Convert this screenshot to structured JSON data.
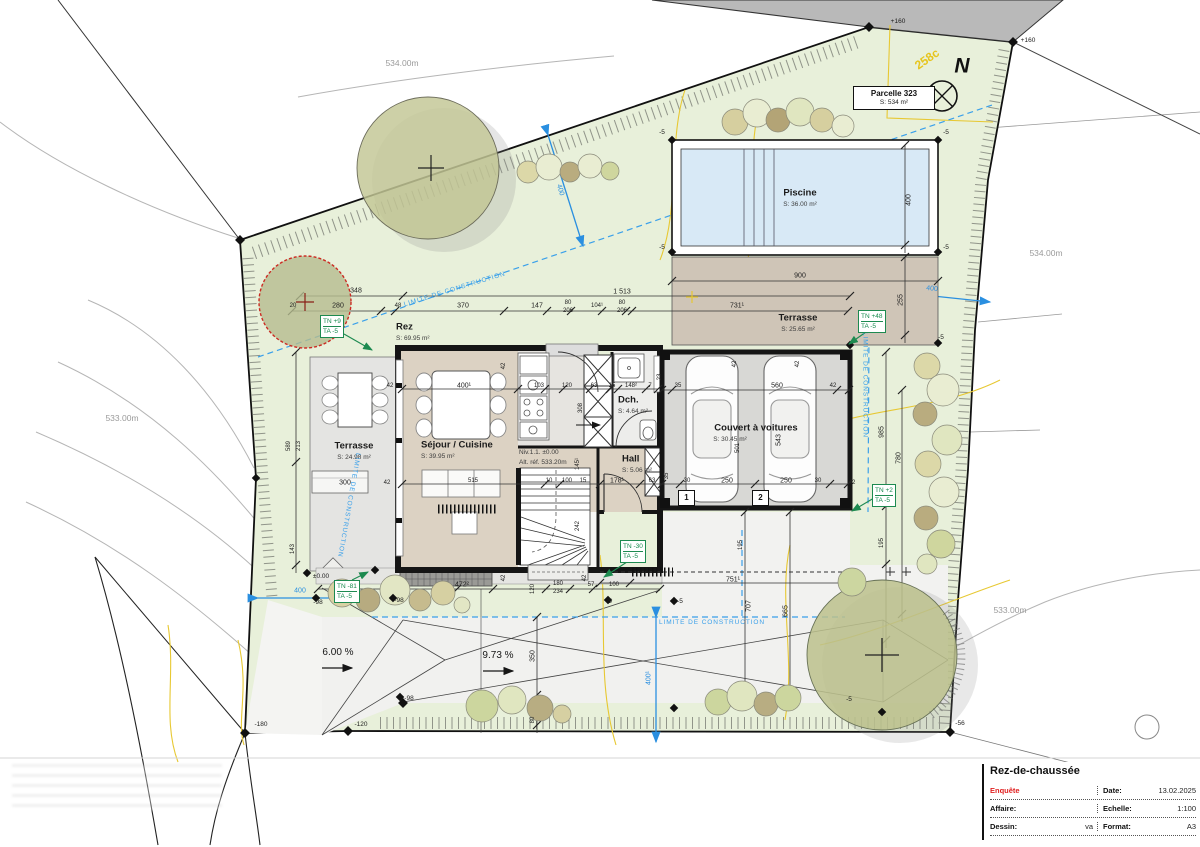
{
  "title_block": {
    "title": "Rez-de-chaussée",
    "rows": [
      {
        "l": "Enquête",
        "lv": "",
        "rl": "Date:",
        "rv": "13.02.2025"
      },
      {
        "l": "Affaire:",
        "lv": "",
        "rl": "Echelle:",
        "rv": "1:100"
      },
      {
        "l": "Dessin:",
        "lv": "va",
        "rl": "Format:",
        "rv": "A3"
      }
    ]
  },
  "parcel_box": {
    "name": "Parcelle 323",
    "area": "S: 534 m²"
  },
  "north": {
    "letter": "N",
    "zone_code": "258c"
  },
  "terrain_tags": [
    {
      "tn": "TN +9",
      "ta": "TA -5"
    },
    {
      "tn": "TN +48",
      "ta": "TA -5"
    },
    {
      "tn": "TN +2",
      "ta": "TA -5"
    },
    {
      "tn": "TN -30",
      "ta": "TA -5"
    },
    {
      "tn": "TN -81",
      "ta": "TA -5"
    }
  ],
  "parking_spots": [
    "1",
    "2"
  ],
  "plan": {
    "labels": [
      {
        "t": "534.00m",
        "x": 402,
        "y": 63,
        "c": "contour"
      },
      {
        "t": "534.00m",
        "x": 1046,
        "y": 253,
        "c": "contour"
      },
      {
        "t": "533.00m",
        "x": 122,
        "y": 418,
        "c": "contour"
      },
      {
        "t": "533.00m",
        "x": 1010,
        "y": 610,
        "c": "contour"
      },
      {
        "t": "+160",
        "x": 898,
        "y": 22,
        "c": "marker"
      },
      {
        "t": "+160",
        "x": 1028,
        "y": 41,
        "c": "marker"
      },
      {
        "t": "258c",
        "x": 927,
        "y": 59,
        "c": "yellow",
        "r": -35
      },
      {
        "t": "N",
        "x": 962,
        "y": 66,
        "c": "north"
      },
      {
        "t": "Piscine",
        "x": 800,
        "y": 193,
        "c": "room"
      },
      {
        "t": "S: 36.00 m²",
        "x": 800,
        "y": 205,
        "c": "area"
      },
      {
        "t": "Terrasse",
        "x": 798,
        "y": 318,
        "c": "room"
      },
      {
        "t": "S: 25.65 m²",
        "x": 798,
        "y": 330,
        "c": "area"
      },
      {
        "t": "Rez",
        "x": 396,
        "y": 327,
        "c": "room",
        "a": "l"
      },
      {
        "t": "S: 69.95 m²",
        "x": 396,
        "y": 339,
        "c": "area",
        "a": "l"
      },
      {
        "t": "Séjour / Cuisine",
        "x": 421,
        "y": 445,
        "c": "room",
        "a": "l"
      },
      {
        "t": "S: 39.95 m²",
        "x": 421,
        "y": 457,
        "c": "area",
        "a": "l"
      },
      {
        "t": "Dch.",
        "x": 618,
        "y": 400,
        "c": "room",
        "a": "l"
      },
      {
        "t": "S: 4.64 m²",
        "x": 618,
        "y": 412,
        "c": "area",
        "a": "l"
      },
      {
        "t": "Hall",
        "x": 622,
        "y": 459,
        "c": "room",
        "a": "l"
      },
      {
        "t": "S: 5.06 m²",
        "x": 622,
        "y": 471,
        "c": "area",
        "a": "l"
      },
      {
        "t": "Terrasse",
        "x": 354,
        "y": 446,
        "c": "room"
      },
      {
        "t": "S: 24.98 m²",
        "x": 354,
        "y": 458,
        "c": "area"
      },
      {
        "t": "Couvert à voitures",
        "x": 756,
        "y": 428,
        "c": "room"
      },
      {
        "t": "S: 30.45 m²",
        "x": 730,
        "y": 440,
        "c": "area"
      },
      {
        "t": "Niv.1.1. ±0.00",
        "x": 519,
        "y": 453,
        "c": "area",
        "a": "l"
      },
      {
        "t": "Alt. réf. 533.20m",
        "x": 519,
        "y": 463,
        "c": "area",
        "a": "l"
      },
      {
        "t": "348",
        "x": 356,
        "y": 291,
        "c": "dim"
      },
      {
        "t": "1 513",
        "x": 622,
        "y": 292,
        "c": "dim"
      },
      {
        "t": "900",
        "x": 800,
        "y": 276,
        "c": "dim"
      },
      {
        "t": "20",
        "x": 293,
        "y": 306,
        "c": "dimsm"
      },
      {
        "t": "280",
        "x": 338,
        "y": 306,
        "c": "dim"
      },
      {
        "t": "48",
        "x": 398,
        "y": 306,
        "c": "dimsm"
      },
      {
        "t": "370",
        "x": 463,
        "y": 306,
        "c": "dim"
      },
      {
        "t": "147",
        "x": 537,
        "y": 306,
        "c": "dim"
      },
      {
        "t": "80",
        "x": 568,
        "y": 303,
        "c": "dimsm"
      },
      {
        "t": "206",
        "x": 568,
        "y": 311,
        "c": "dimsm"
      },
      {
        "t": "104¹",
        "x": 597,
        "y": 306,
        "c": "dimsm"
      },
      {
        "t": "80",
        "x": 622,
        "y": 303,
        "c": "dimsm"
      },
      {
        "t": "206",
        "x": 622,
        "y": 311,
        "c": "dimsm"
      },
      {
        "t": "731¹",
        "x": 737,
        "y": 306,
        "c": "dim"
      },
      {
        "t": "400",
        "x": 909,
        "y": 200,
        "c": "dim",
        "r": -90
      },
      {
        "t": "255",
        "x": 901,
        "y": 300,
        "c": "dim",
        "r": -90
      },
      {
        "t": "589",
        "x": 289,
        "y": 446,
        "c": "dimsm",
        "r": -90
      },
      {
        "t": "213",
        "x": 299,
        "y": 446,
        "c": "dimsm",
        "r": -90
      },
      {
        "t": "143",
        "x": 293,
        "y": 549,
        "c": "dimsm",
        "r": -90
      },
      {
        "t": "42",
        "x": 390,
        "y": 386,
        "c": "dimsm"
      },
      {
        "t": "400¹",
        "x": 464,
        "y": 386,
        "c": "dim"
      },
      {
        "t": "103",
        "x": 539,
        "y": 386,
        "c": "dimsm"
      },
      {
        "t": "120",
        "x": 567,
        "y": 386,
        "c": "dimsm"
      },
      {
        "t": "63",
        "x": 594,
        "y": 386,
        "c": "dimsm"
      },
      {
        "t": "15",
        "x": 612,
        "y": 386,
        "c": "dimsm"
      },
      {
        "t": "148²",
        "x": 631,
        "y": 386,
        "c": "dimsm"
      },
      {
        "t": "7",
        "x": 650,
        "y": 386,
        "c": "dimsm"
      },
      {
        "t": "23",
        "x": 660,
        "y": 377,
        "c": "dimsm",
        "r": -90
      },
      {
        "t": "308",
        "x": 581,
        "y": 408,
        "c": "dimsm",
        "r": -90
      },
      {
        "t": "42",
        "x": 504,
        "y": 366,
        "c": "dimsm",
        "r": -90
      },
      {
        "t": "35",
        "x": 678,
        "y": 386,
        "c": "dimsm"
      },
      {
        "t": "560",
        "x": 777,
        "y": 386,
        "c": "dim"
      },
      {
        "t": "42",
        "x": 833,
        "y": 386,
        "c": "dimsm"
      },
      {
        "t": "42",
        "x": 735,
        "y": 364,
        "c": "dimsm",
        "r": -90
      },
      {
        "t": "42",
        "x": 798,
        "y": 364,
        "c": "dimsm",
        "r": -90
      },
      {
        "t": "543",
        "x": 779,
        "y": 440,
        "c": "dim",
        "r": -90
      },
      {
        "t": "501",
        "x": 738,
        "y": 448,
        "c": "dimsm",
        "r": -90
      },
      {
        "t": "515",
        "x": 473,
        "y": 481,
        "c": "dimsm"
      },
      {
        "t": "10",
        "x": 549,
        "y": 481,
        "c": "dimsm"
      },
      {
        "t": "100",
        "x": 567,
        "y": 481,
        "c": "dimsm"
      },
      {
        "t": "15",
        "x": 583,
        "y": 481,
        "c": "dimsm"
      },
      {
        "t": "178¹",
        "x": 617,
        "y": 481,
        "c": "dim"
      },
      {
        "t": "63",
        "x": 652,
        "y": 481,
        "c": "dimsm"
      },
      {
        "t": "30",
        "x": 687,
        "y": 481,
        "c": "dimsm"
      },
      {
        "t": "250",
        "x": 727,
        "y": 481,
        "c": "dim"
      },
      {
        "t": "250",
        "x": 786,
        "y": 481,
        "c": "dim"
      },
      {
        "t": "30",
        "x": 818,
        "y": 481,
        "c": "dimsm"
      },
      {
        "t": "35",
        "x": 667,
        "y": 476,
        "c": "dimsm",
        "r": -90
      },
      {
        "t": "145¹",
        "x": 578,
        "y": 464,
        "c": "dimsm",
        "r": -90
      },
      {
        "t": "242",
        "x": 578,
        "y": 526,
        "c": "dimsm",
        "r": -90
      },
      {
        "t": "300",
        "x": 345,
        "y": 483,
        "c": "dim"
      },
      {
        "t": "42",
        "x": 387,
        "y": 483,
        "c": "dimsm"
      },
      {
        "t": "42",
        "x": 852,
        "y": 483,
        "c": "dimsm"
      },
      {
        "t": "985",
        "x": 882,
        "y": 432,
        "c": "dim",
        "r": -90
      },
      {
        "t": "780",
        "x": 899,
        "y": 458,
        "c": "dim",
        "r": -90
      },
      {
        "t": "195",
        "x": 882,
        "y": 543,
        "c": "dimsm",
        "r": -90
      },
      {
        "t": "195",
        "x": 741,
        "y": 545,
        "c": "dimsm",
        "r": -90
      },
      {
        "t": "472²",
        "x": 462,
        "y": 585,
        "c": "dim"
      },
      {
        "t": "120",
        "x": 533,
        "y": 589,
        "c": "dimsm",
        "r": -90
      },
      {
        "t": "180",
        "x": 558,
        "y": 584,
        "c": "dimsm"
      },
      {
        "t": "234",
        "x": 558,
        "y": 592,
        "c": "dimsm"
      },
      {
        "t": "57",
        "x": 591,
        "y": 585,
        "c": "dimsm"
      },
      {
        "t": "100",
        "x": 614,
        "y": 585,
        "c": "dimsm"
      },
      {
        "t": "42",
        "x": 504,
        "y": 578,
        "c": "dimsm",
        "r": -90
      },
      {
        "t": "42",
        "x": 585,
        "y": 578,
        "c": "dimsm",
        "r": -90
      },
      {
        "t": "751¹",
        "x": 733,
        "y": 580,
        "c": "dim"
      },
      {
        "t": "707",
        "x": 749,
        "y": 606,
        "c": "dim",
        "r": -90
      },
      {
        "t": "665",
        "x": 786,
        "y": 611,
        "c": "dim",
        "r": -90
      },
      {
        "t": "350",
        "x": 533,
        "y": 656,
        "c": "dim",
        "r": -90
      },
      {
        "t": "80",
        "x": 533,
        "y": 720,
        "c": "dimsm",
        "r": -90
      },
      {
        "t": "-5",
        "x": 662,
        "y": 133,
        "c": "marker"
      },
      {
        "t": "-5",
        "x": 946,
        "y": 133,
        "c": "marker"
      },
      {
        "t": "-5",
        "x": 662,
        "y": 248,
        "c": "marker"
      },
      {
        "t": "-5",
        "x": 946,
        "y": 248,
        "c": "marker"
      },
      {
        "t": "-5",
        "x": 941,
        "y": 338,
        "c": "marker"
      },
      {
        "t": "-5",
        "x": 609,
        "y": 602,
        "c": "marker"
      },
      {
        "t": "-5",
        "x": 680,
        "y": 602,
        "c": "marker"
      },
      {
        "t": "-5",
        "x": 849,
        "y": 700,
        "c": "marker"
      },
      {
        "t": "-56",
        "x": 960,
        "y": 724,
        "c": "marker"
      },
      {
        "t": "-98",
        "x": 318,
        "y": 603,
        "c": "marker"
      },
      {
        "t": "-98",
        "x": 399,
        "y": 601,
        "c": "marker"
      },
      {
        "t": "-98",
        "x": 409,
        "y": 699,
        "c": "marker"
      },
      {
        "t": "-120",
        "x": 361,
        "y": 725,
        "c": "marker"
      },
      {
        "t": "-180",
        "x": 261,
        "y": 725,
        "c": "marker"
      },
      {
        "t": "±0.00",
        "x": 321,
        "y": 577,
        "c": "marker"
      },
      {
        "t": "400",
        "x": 300,
        "y": 591,
        "c": "blue"
      },
      {
        "t": "400",
        "x": 932,
        "y": 289,
        "c": "blue",
        "r": 6
      },
      {
        "t": "400",
        "x": 560,
        "y": 190,
        "c": "blue",
        "r": 73
      },
      {
        "t": "400¹",
        "x": 649,
        "y": 678,
        "c": "blue",
        "r": -90
      },
      {
        "t": "LIMITE DE CONSTRUCTION",
        "x": 455,
        "y": 290,
        "c": "limit",
        "r": -17
      },
      {
        "t": "LIMITE DE CONSTRUCTION",
        "x": 712,
        "y": 623,
        "c": "limit"
      },
      {
        "t": "LIMITE DE CONSTRUCTION",
        "x": 864,
        "y": 385,
        "c": "limit",
        "r": 90
      },
      {
        "t": "LIMITE DE CONSTRUCTION",
        "x": 348,
        "y": 505,
        "c": "limit",
        "r": 100
      },
      {
        "t": "6.00 %",
        "x": 338,
        "y": 653,
        "c": "slope"
      },
      {
        "t": "9.73 %",
        "x": 498,
        "y": 656,
        "c": "slope"
      }
    ]
  }
}
